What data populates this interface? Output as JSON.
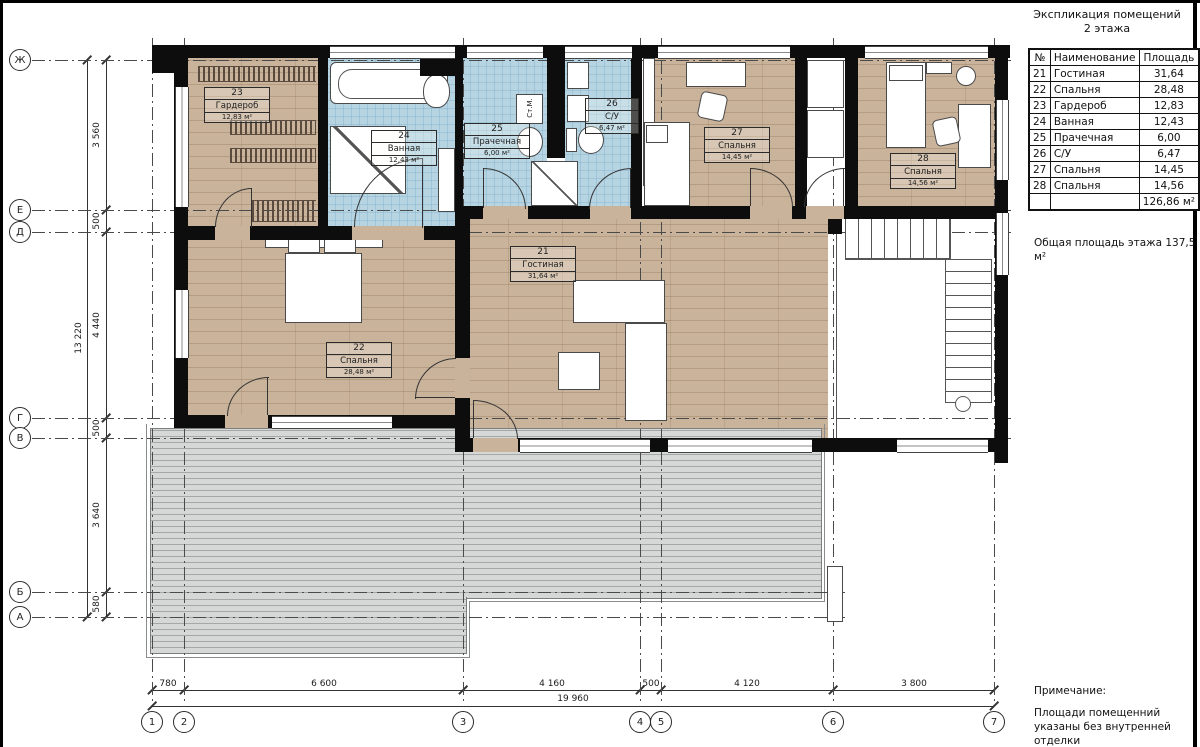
{
  "sheet": {
    "spec_title_1": "Экспликация помещений",
    "spec_title_2": "2 этажа",
    "floor_total": "Общая площадь этажа 137,5 м²",
    "note_title": "Примечание:",
    "note_body": "Площади помещенний указаны без внутренней отделки"
  },
  "spec_table": {
    "col_num": "№",
    "col_name": "Наименование",
    "col_area": "Площадь",
    "total_area": "126,86 м²"
  },
  "rooms": [
    {
      "num": "21",
      "name": "Гостиная",
      "area": "31,64",
      "area_plan": "31,64 м²"
    },
    {
      "num": "22",
      "name": "Спальня",
      "area": "28,48",
      "area_plan": "28,48 м²"
    },
    {
      "num": "23",
      "name": "Гардероб",
      "area": "12,83",
      "area_plan": "12,83 м²"
    },
    {
      "num": "24",
      "name": "Ванная",
      "area": "12,43",
      "area_plan": "12,43 м²"
    },
    {
      "num": "25",
      "name": "Прачечная",
      "area": "6,00",
      "area_plan": "6,00 м²"
    },
    {
      "num": "26",
      "name": "С/У",
      "area": "6,47",
      "area_plan": "6,47 м²"
    },
    {
      "num": "27",
      "name": "Спальня",
      "area": "14,45",
      "area_plan": "14,45 м²"
    },
    {
      "num": "28",
      "name": "Спальня",
      "area": "14,56",
      "area_plan": "14,56 м²"
    }
  ],
  "plan": {
    "washing_machine": "Ст.М."
  },
  "axes": {
    "rows": [
      "Ж",
      "Е",
      "Д",
      "Г",
      "В",
      "Б",
      "А"
    ],
    "cols": [
      "1",
      "2",
      "3",
      "4",
      "5",
      "6",
      "7"
    ]
  },
  "dims": {
    "left": [
      "3 560",
      "500",
      "4 440",
      "500",
      "3 640",
      "580"
    ],
    "left_total": "13 220",
    "bottom": [
      "780",
      "6 600",
      "4 160",
      "500",
      "4 120",
      "3 800"
    ],
    "bottom_total": "19 960"
  },
  "colors": {
    "wood": "#cab39b",
    "tile": "#b6d4e2",
    "deck": "#d6d8d7",
    "wall": "#0d0d0d"
  }
}
